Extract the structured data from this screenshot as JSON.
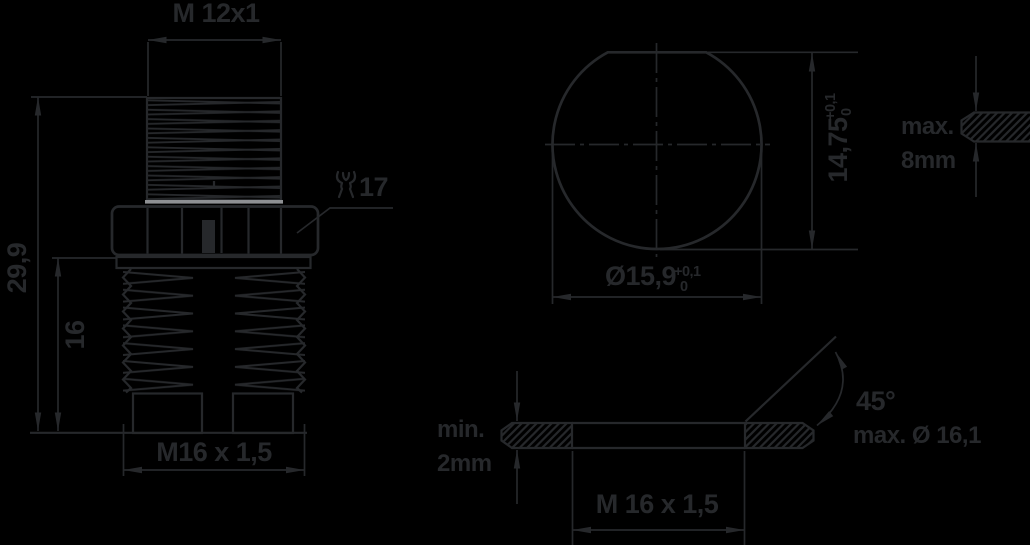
{
  "colors": {
    "background": "#000000",
    "line": "#26282b",
    "seal": "#8e9093"
  },
  "front_view": {
    "top_thread_label": "M 12x1",
    "overall_height": "29,9",
    "rear_thread_length": "16",
    "rear_thread_label": "M16 x 1,5",
    "wrench_size": "17"
  },
  "hole_view": {
    "width_across_flat": "14,75",
    "width_tol_upper": "+0,1",
    "width_tol_lower": "0",
    "diameter": "Ø15,9",
    "dia_tol_upper": "+0,1",
    "dia_tol_lower": "0"
  },
  "panel_view": {
    "qualifier": "max.",
    "thickness": "8mm"
  },
  "mounting_view": {
    "qualifier": "min.",
    "thickness": "2mm",
    "thread": "M 16 x 1,5",
    "chamfer_angle": "45°",
    "chamfer_max_dia": "max. Ø 16,1"
  }
}
